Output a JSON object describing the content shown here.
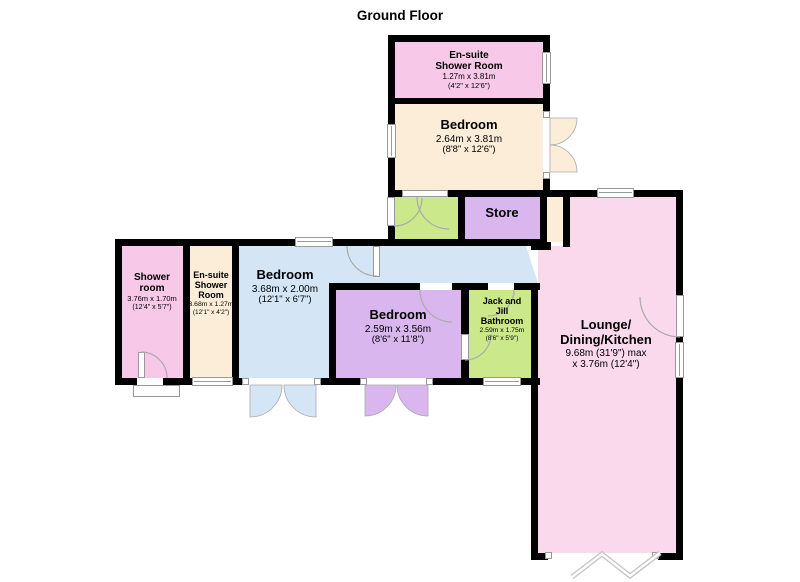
{
  "title": "Ground Floor",
  "colors": {
    "wall": "#000000",
    "pink": "#F8C8E8",
    "lounge_pink": "#FBD9EC",
    "cream": "#FBEDD8",
    "green": "#CBE98B",
    "purple": "#D9B7EE",
    "blue": "#D4E6F6",
    "window_frame": "#999999",
    "door_arc": "#AAAAAA"
  },
  "rooms": {
    "ensuite_top": {
      "name": "En-suite Shower Room",
      "dims_m": "1.27m x 3.81m",
      "dims_ft": "(4'2\" x 12'6\")"
    },
    "bedroom_top": {
      "name": "Bedroom",
      "dims_m": "2.64m x 3.81m",
      "dims_ft": "(8'8\" x 12'6\")"
    },
    "store": {
      "name": "Store"
    },
    "shower": {
      "name": "Shower room",
      "dims_m": "3.76m x 1.70m",
      "dims_ft": "(12'4\" x 5'7\")"
    },
    "ensuite_left": {
      "name": "En-suite Shower Room",
      "dims_m": "3.68m x 1.27m",
      "dims_ft": "(12'1\" x 4'2\")"
    },
    "bedroom_mid": {
      "name": "Bedroom",
      "dims_m": "3.68m x 2.00m",
      "dims_ft": "(12'1\" x 6'7\")"
    },
    "bedroom_purple": {
      "name": "Bedroom",
      "dims_m": "2.59m x 3.56m",
      "dims_ft": "(8'6\" x 11'8\")"
    },
    "jack_jill": {
      "name": "Jack and Jill Bathroom",
      "dims_m": "2.59m x 1.75m",
      "dims_ft": "(8'6\" x 5'9\")"
    },
    "lounge": {
      "name": "Lounge/ Dining/Kitchen",
      "dims_m": "9.68m (31'9\") max",
      "dims_ft": "x 3.76m (12'4\")"
    }
  }
}
